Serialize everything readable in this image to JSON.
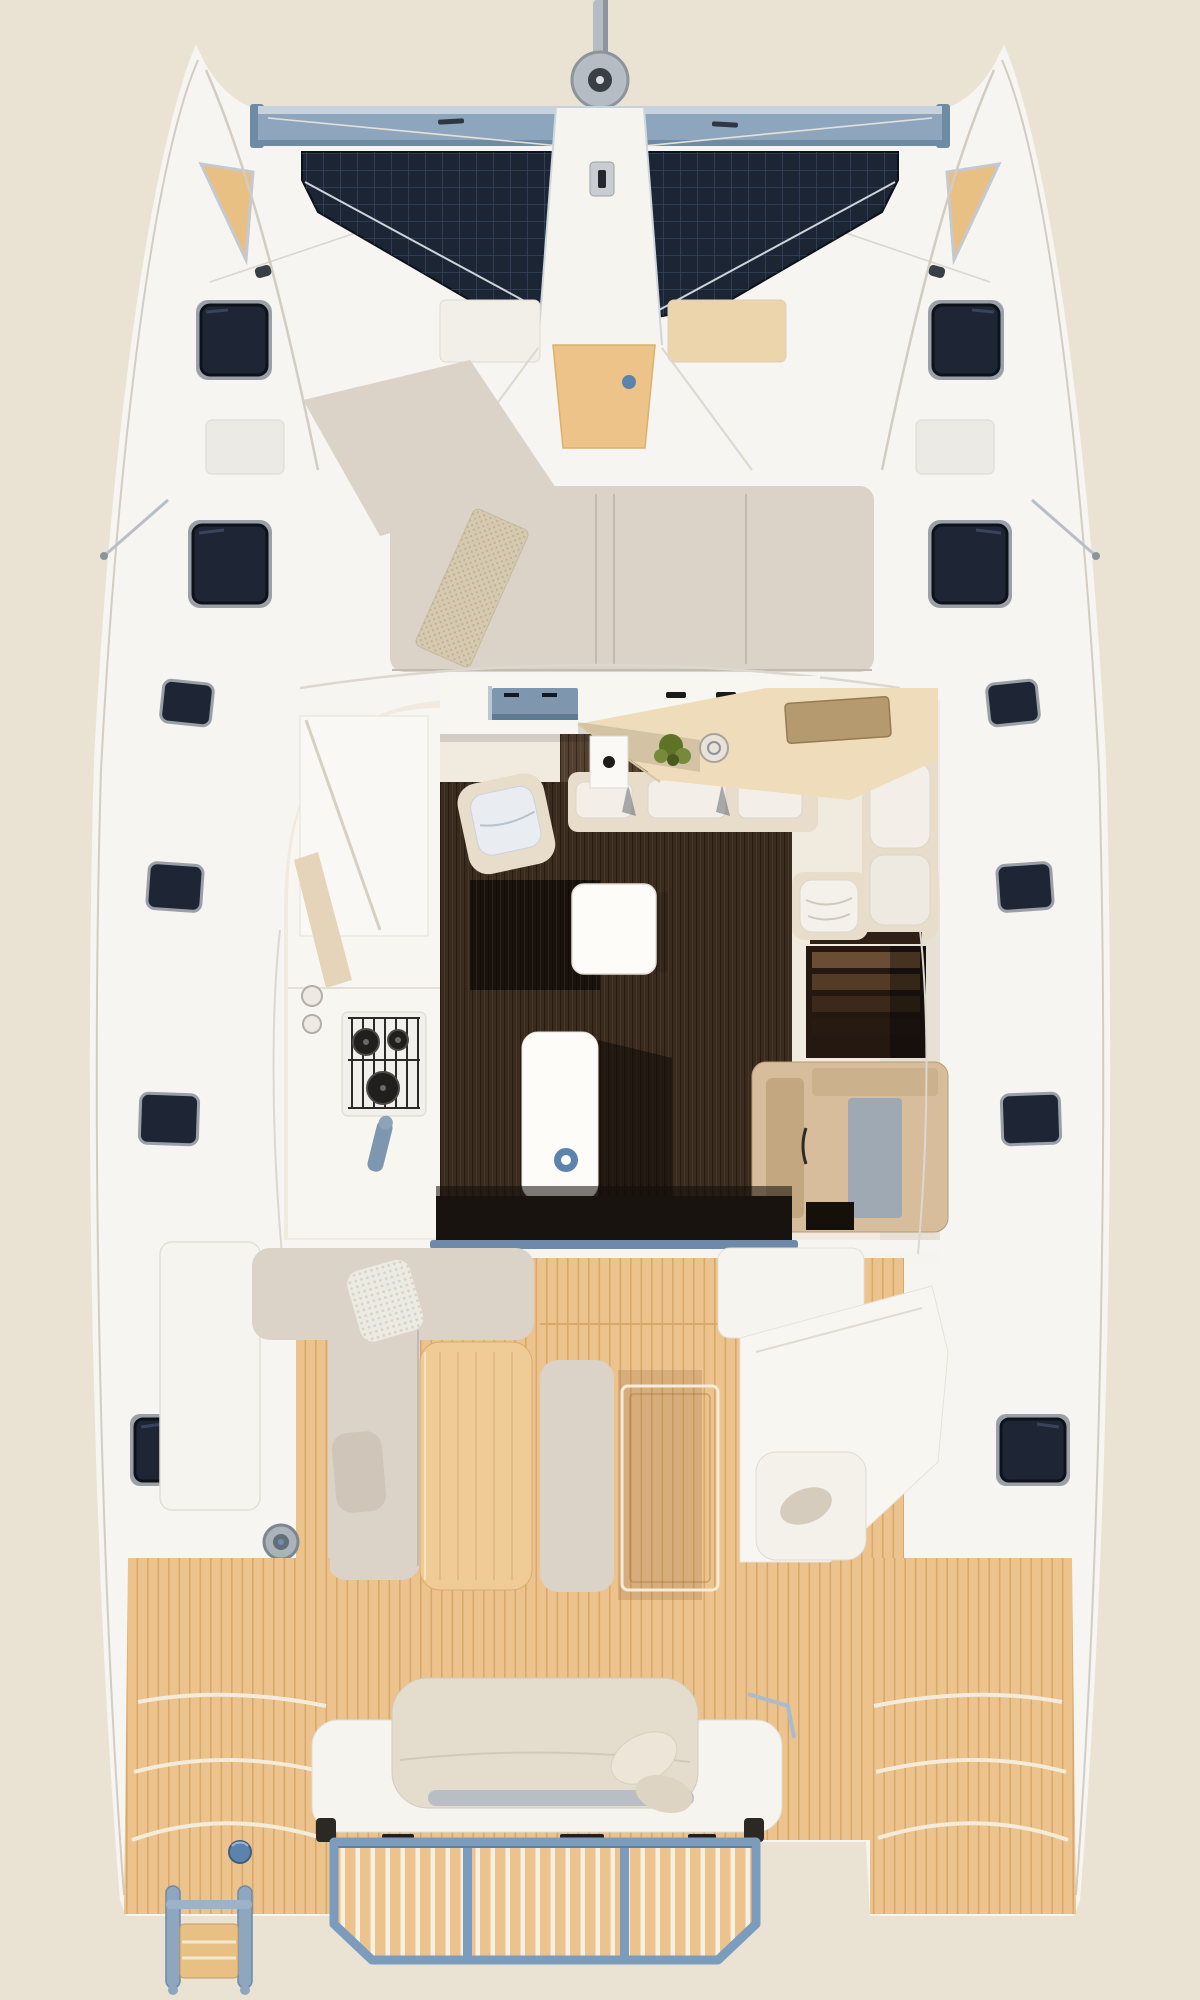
{
  "meta": {
    "title": "Catamaran deck plan — top-down view",
    "description": "Top-down 3D rendered deck plan of a sailing catamaran showing bow trampolines, foredeck lounge, saloon with galley and dining area, aft cockpit with teak sole, stern sunbed and fold-down swim platform"
  },
  "canvas": {
    "width": 1200,
    "height": 2000
  },
  "parts": {
    "bowsprit": "Bowsprit with furler drum",
    "crossbeam": "Forward aluminium crossbeam",
    "trampolinePort": "Port bow trampoline net",
    "trampolineStarboard": "Starboard bow trampoline net",
    "walkway": "Central bow walkway",
    "anchorLocker": "Teak anchor locker lid",
    "foredeckLounge": "Forward cockpit lounge cushions",
    "towel": "Beach towel on sunpad",
    "saloon": "Saloon interior (roof cutaway)",
    "galley": "Galley with sink, 3-burner stove and faucet",
    "hob": "Forward galley hob unit",
    "island": "Galley island unit",
    "diningTable": "Saloon dining table",
    "diningBench": "Dining settee cushions",
    "navSeat": "Navigation seat",
    "stairs": "Companionway stairs to hull",
    "chartCabinet": "Aft chart cabinet",
    "cockpit": "Aft cockpit with teak sole",
    "cockpitTable": "Cockpit table",
    "cockpitLounge": "Port cockpit lounge",
    "helmSeat": "Starboard helm seat module",
    "winch": "Sheet winch",
    "aftSunbed": "Aft transom sunbed",
    "swimPlatform": "Fold-down swim platform",
    "transomPort": "Port transom steps",
    "transomStarboard": "Starboard transom steps",
    "ladder": "Port boarding ladder",
    "hatches": "Deck hatches",
    "plant": "Potted plant on galley counter"
  },
  "colors": {
    "bg": "#eae3d4",
    "hull": "#f7f5f1",
    "hullLine": "#d2ccc2",
    "deckSeam": "#dcd7cf",
    "beam": "#8ea6bd",
    "beamLight": "#c6d2dd",
    "beamDark": "#6f8ba4",
    "mast": "#b6bcc3",
    "mastDark": "#8d949c",
    "furlerHub": "#3a3f46",
    "tramp": "#1b2534",
    "trampGrid": "#34435d",
    "bowWood": "#e9c084",
    "woodLid": "#eec389",
    "lidTan": "#ecd4ac",
    "accentBlue": "#5b83ad",
    "frameBlue": "#7b9cbd",
    "sillBlue": "#6d8aa8",
    "ladderBlue": "#8fa6bf",
    "cushion": "#dbd3c8",
    "cushionShade": "#c3bab0",
    "cushionDark": "#cfc6b9",
    "towel": "#d5c9b1",
    "towelDot": "#c0b08d",
    "white": "#f6f4ef",
    "counter": "#f8f6f1",
    "interior": "#f1eadf",
    "cream": "#e8dccb",
    "cushionWhite": "#f3efe8",
    "cushionBlue": "#e9edf1",
    "hob": "#7e96ae",
    "hobDark": "#5d7a96",
    "counterTan": "#eedcba",
    "board": "#b59a70",
    "plant": "#5f7326",
    "plantLight": "#778a3b",
    "floor": "#3a2b1e",
    "floorLight": "#53402f",
    "floorDark": "#140d08",
    "island": "#fdfcf9",
    "stairs": "#241811",
    "cabinet": "#d7bd9b",
    "cabinetDark": "#c2a781",
    "cabinetGray": "#9fa9b4",
    "door": "#191310",
    "teak": "#ecc28d",
    "teakLine": "#d9a96b",
    "caulk": "#f4ebdb",
    "slatGap": "#f7efe0",
    "tableWood": "#efcc95",
    "hatch": "#1e2636",
    "hatchFrame": "#9aa0a8",
    "hatchDark": "#0d1118",
    "winch": "#aab2ba",
    "knit": "#ecebe3",
    "knitDot": "#d7d2c4"
  }
}
